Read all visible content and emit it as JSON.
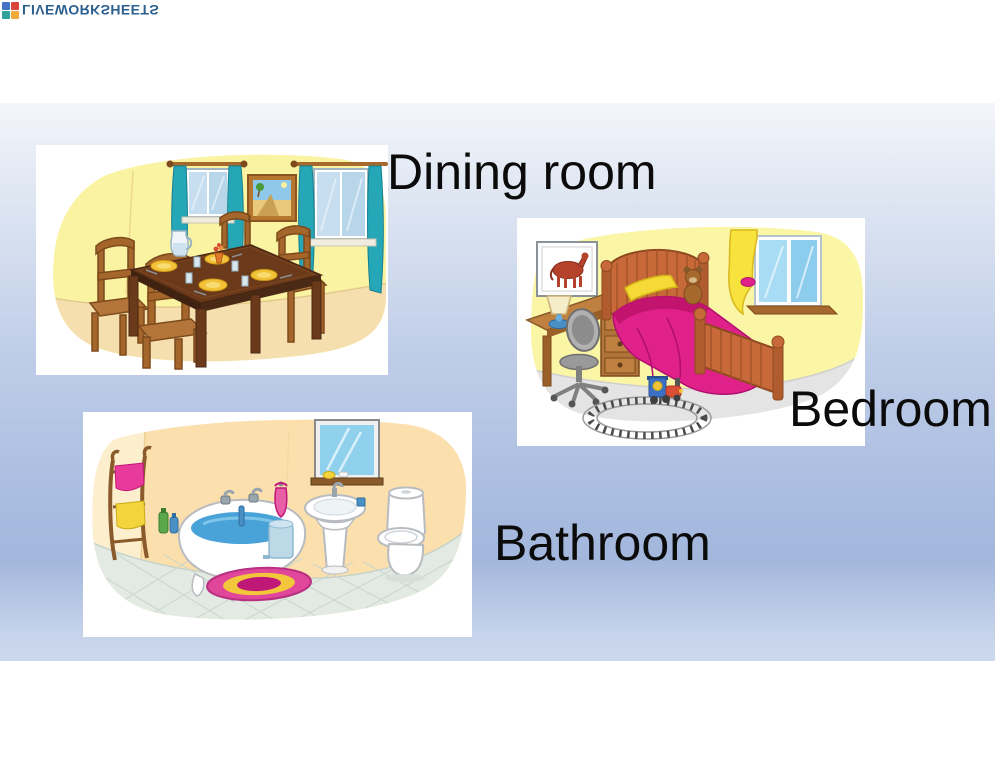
{
  "watermark": {
    "text": "LIVEWORKSHEETS",
    "text_color": "#2b5f8e",
    "orientation": "flipped-vertically",
    "logo_square_colors": [
      "#4472c4",
      "#d9453a",
      "#2fa39b",
      "#f2a93b"
    ]
  },
  "background": {
    "page_color": "#ffffff",
    "slide_gradient_top": "#f3f6fa",
    "slide_gradient_mid": "#a6badf",
    "slide_gradient_bottom": "#ccd9ee"
  },
  "label_text_color": "#0b0b0b",
  "rooms": [
    {
      "id": "dining-room",
      "label": "Dining room"
    },
    {
      "id": "bedroom",
      "label": "Bedroom"
    },
    {
      "id": "bathroom",
      "label": "Bathroom"
    }
  ]
}
